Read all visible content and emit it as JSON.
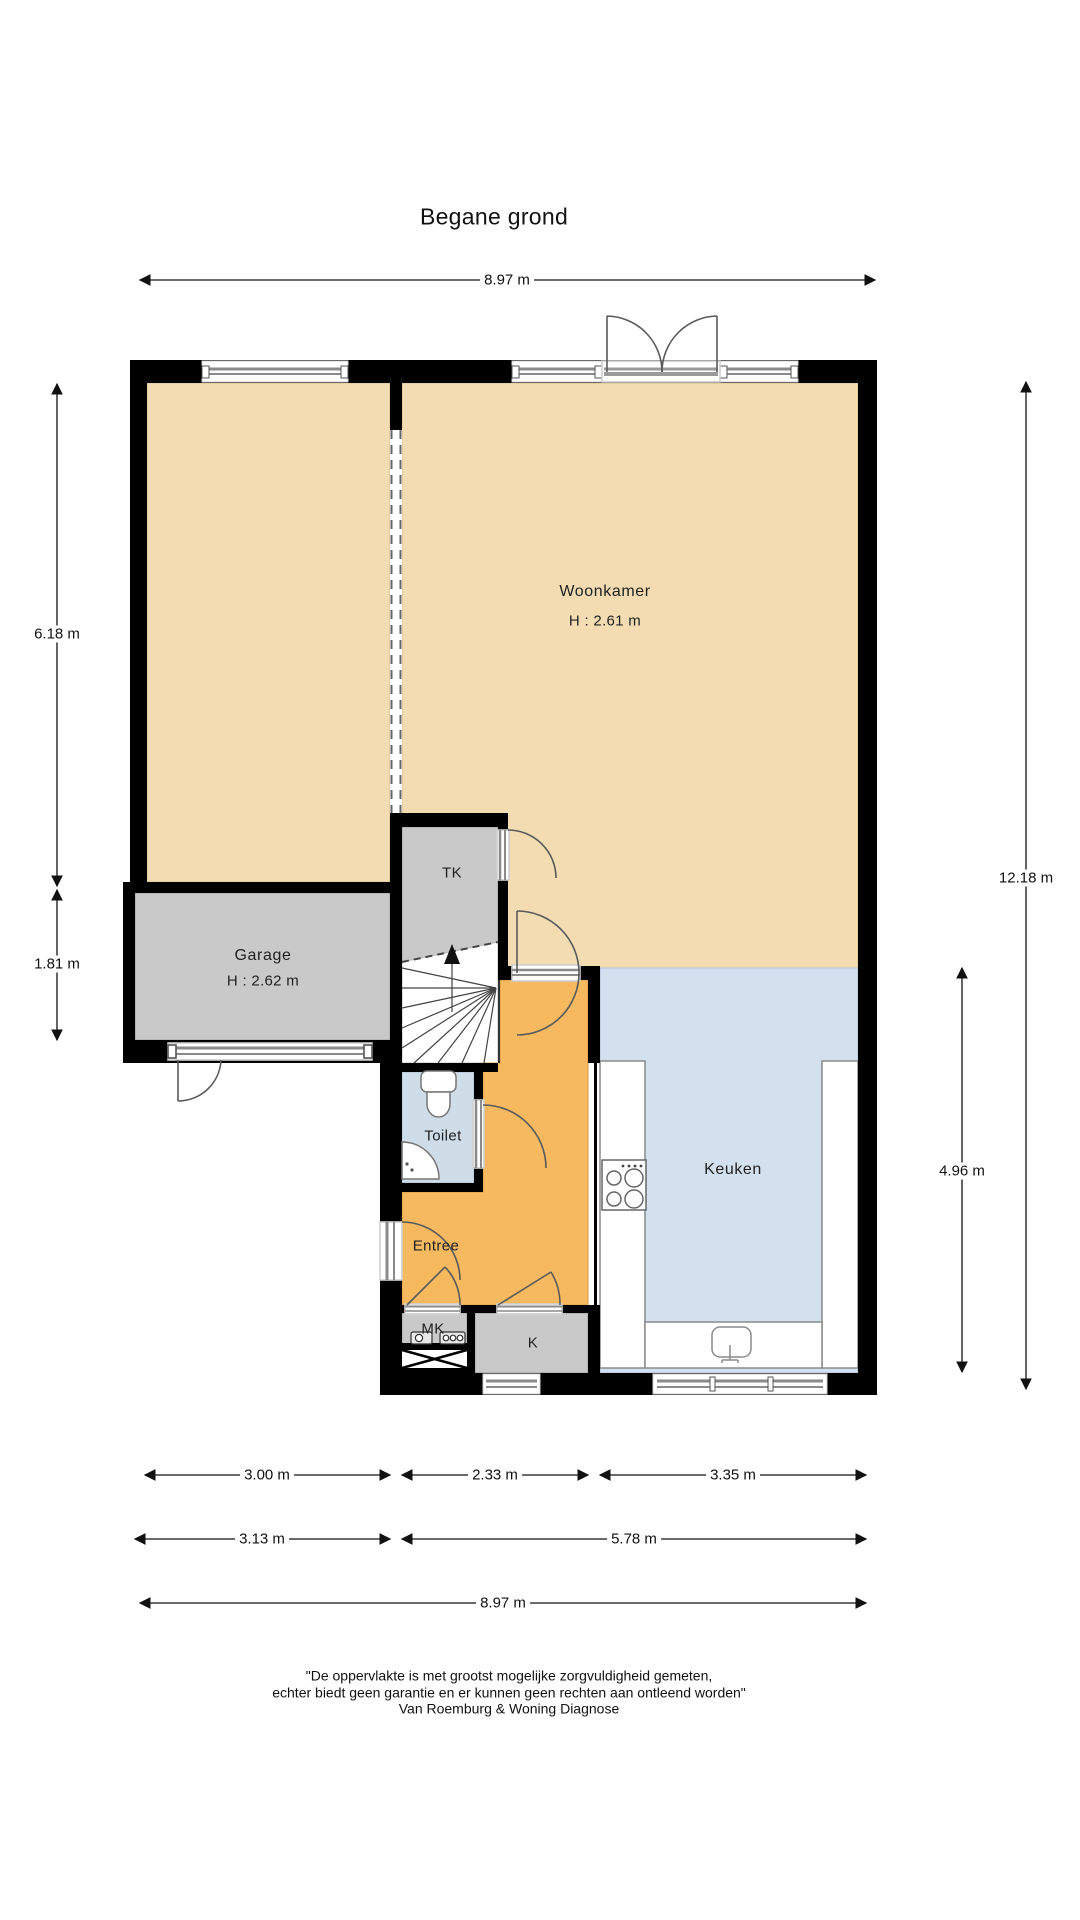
{
  "title": "Begane grond",
  "rooms": {
    "woonkamer": {
      "label": "Woonkamer",
      "height": "H : 2.61 m"
    },
    "garage": {
      "label": "Garage",
      "height": "H : 2.62 m"
    },
    "tk": {
      "label": "TK"
    },
    "toilet": {
      "label": "Toilet"
    },
    "entree": {
      "label": "Entree"
    },
    "mk": {
      "label": "MK"
    },
    "k": {
      "label": "K"
    },
    "keuken": {
      "label": "Keuken"
    }
  },
  "dimensions": {
    "top_width": "8.97 m",
    "left_upper": "6.18 m",
    "left_lower": "1.81 m",
    "right_total": "12.18 m",
    "right_kitchen": "4.96 m",
    "bottom_row1": [
      "3.00 m",
      "2.33 m",
      "3.35 m"
    ],
    "bottom_row2": [
      "3.13 m",
      "5.78 m"
    ],
    "bottom_row3": "8.97 m"
  },
  "disclaimer": {
    "line1": "\"De oppervlakte is met grootst mogelijke zorgvuldigheid gemeten,",
    "line2": "echter biedt geen garantie en er kunnen geen rechten aan ontleend worden\"",
    "line3": "Van Roemburg & Woning Diagnose"
  },
  "colors": {
    "floor_tan": "#f3dcb1",
    "floor_gray": "#c9c9c9",
    "floor_toilet": "#cfdde9",
    "floor_kitchen": "#d3e0ee",
    "floor_orange": "#f6b95f",
    "wall": "#000000"
  }
}
